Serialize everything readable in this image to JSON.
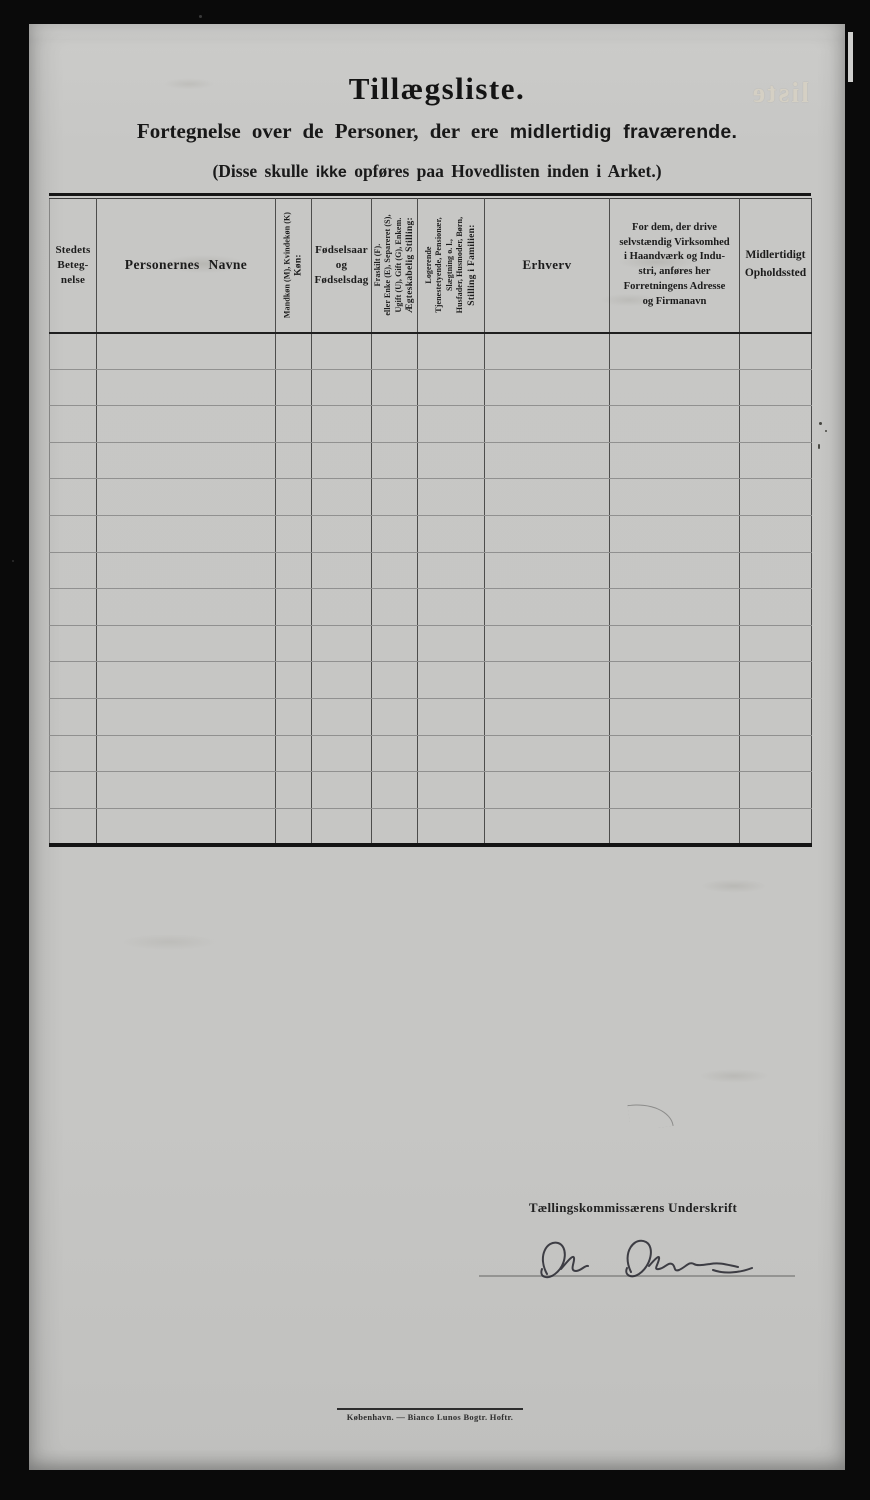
{
  "page": {
    "title": "Tillægsliste.",
    "subtitle_prefix": "Fortegnelse over de Personer, der ere ",
    "subtitle_bold": "midlertidig fraværende.",
    "note_prefix": "(Disse skulle ",
    "note_bold": "ikke",
    "note_suffix": " opføres paa Hovedlisten inden i Arket.)",
    "bleedthrough_text": "liste"
  },
  "table": {
    "row_count": 14,
    "columns": [
      {
        "id": "stedets-betegnelse",
        "label_lines": [
          "Stedets",
          "Beteg-",
          "nelse"
        ]
      },
      {
        "id": "personernes-navne",
        "label": "Personernes Navne"
      },
      {
        "id": "kon",
        "rotated": true,
        "label_lines": [
          "Køn:",
          "Mandkøn (M), Kvindekøn (K)"
        ]
      },
      {
        "id": "fodselsaar",
        "label_lines": [
          "Fødselsaar",
          "og",
          "Fødselsdag"
        ]
      },
      {
        "id": "aegteskabelig-stilling",
        "rotated": true,
        "label_lines": [
          "Ægteskabelig Stilling:",
          "Ugift (U), Gift (G), Enkem.",
          "eller Enke (E), Separeret (S),",
          "Fraskilt (F)."
        ]
      },
      {
        "id": "stilling-i-familien",
        "rotated": true,
        "label_lines": [
          "Stilling i Familien:",
          "Husfader, Husmoder, Børn,",
          "Slægtning o. l.,",
          "Tjenestetyende, Pensionær,",
          "Logerende"
        ]
      },
      {
        "id": "erhverv",
        "label": "Erhverv"
      },
      {
        "id": "virksomhed",
        "label_lines": [
          "For dem, der drive",
          "selvstændig Virksomhed",
          "i Haandværk og Indu-",
          "stri, anføres her",
          "Forretningens Adresse",
          "og Firmanavn"
        ]
      },
      {
        "id": "opholdssted",
        "label_lines": [
          "Midlertidigt",
          "Opholdssted"
        ]
      }
    ]
  },
  "signature": {
    "label": "Tællingskommissærens Underskrift",
    "name": "Ole Olsen"
  },
  "footer": {
    "imprint": "København. — Bianco Lunos Bogtr. Hoftr."
  },
  "colors": {
    "background": "#0a0a0a",
    "paper": "#c7c7c5",
    "ink": "#1c1c1c",
    "signature_ink": "#2b2b33",
    "ghost": "#d8d2c4"
  }
}
